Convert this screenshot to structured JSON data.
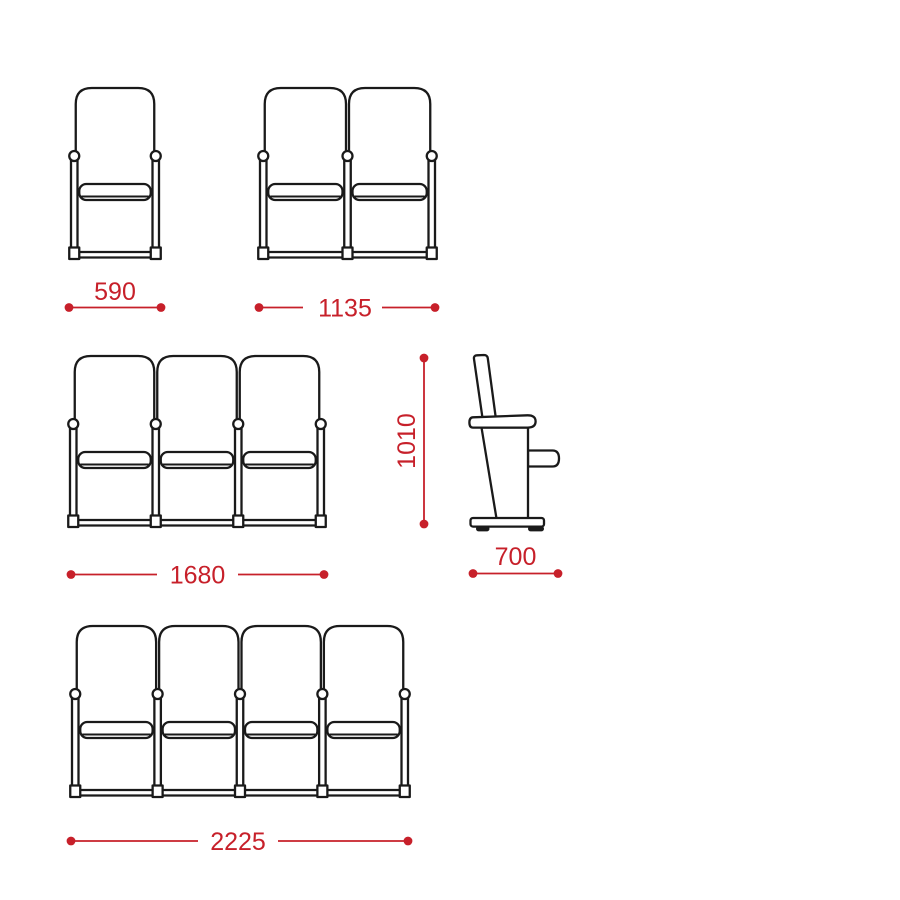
{
  "background": "#ffffff",
  "colors": {
    "dimension": "#c7202a",
    "outline": "#1a1a1a"
  },
  "views": [
    {
      "name": "front-view-1-seat",
      "seats": 1,
      "width_label": "590"
    },
    {
      "name": "front-view-2-seats",
      "seats": 2,
      "width_label": "1135"
    },
    {
      "name": "front-view-3-seats",
      "seats": 3,
      "width_label": "1680"
    },
    {
      "name": "side-view",
      "height_label": "1010",
      "depth_label": "700"
    },
    {
      "name": "front-view-4-seats",
      "seats": 4,
      "width_label": "2225"
    }
  ]
}
